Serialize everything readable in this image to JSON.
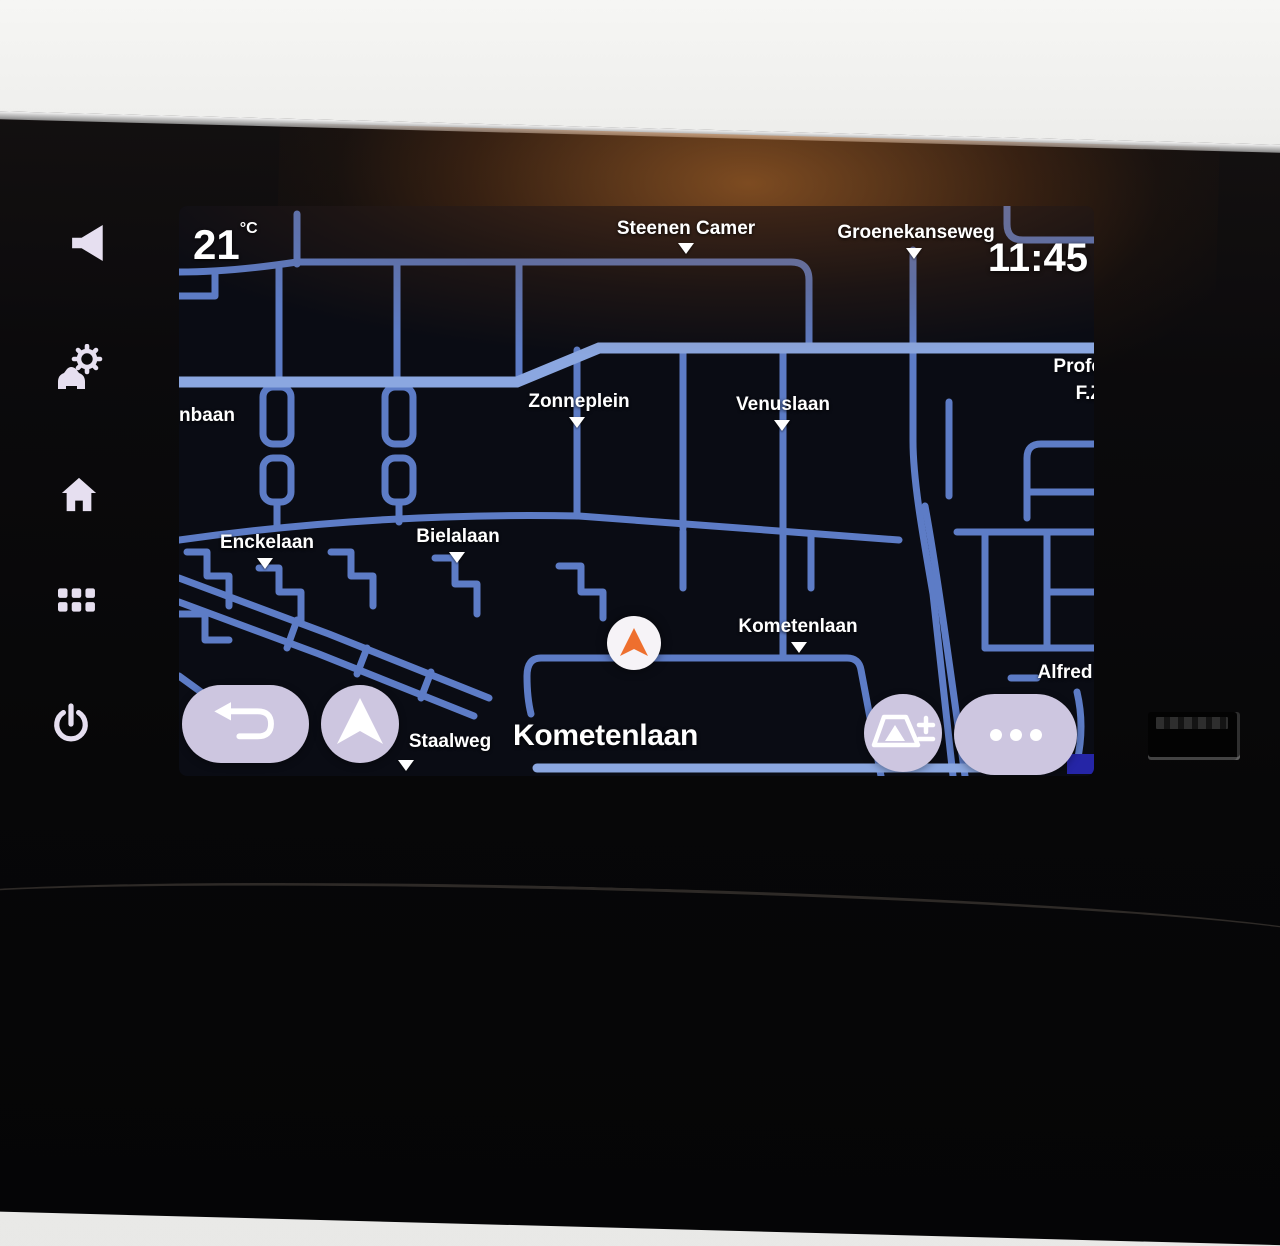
{
  "status_bar": {
    "temperature_value": "21",
    "temperature_unit": "°C",
    "clock": "11:45"
  },
  "map": {
    "current_street": "Kometenlaan",
    "labels": {
      "steenen_camer": "Steenen Camer",
      "groenekanseweg": "Groenekanseweg",
      "zonneplein": "Zonneplein",
      "venuslaan": "Venuslaan",
      "nbaan": "nbaan",
      "professor_line1": "Profe",
      "professor_line2": "F.Z",
      "enckelaan": "Enckelaan",
      "bielalaan": "Bielalaan",
      "kometenlaan": "Kometenlaan",
      "staalweg": "Staalweg",
      "alfred": "Alfred"
    },
    "colors": {
      "map_background": "#0a0c14",
      "road": "#5d7cc6",
      "road_major": "#8ba7e0",
      "label_text": "#ffffff",
      "position_arrow": "#ee6f2e",
      "highlight_rect": "#2525a6",
      "button_background": "#cdc6e0"
    }
  },
  "controls": {
    "back_button_icon": "return-arrow",
    "navigation_button_icon": "navigation-arrow",
    "map_zoom_button_icon": "map-perspective-plus-minus",
    "more_button_icon": "ellipsis"
  },
  "bezel_buttons": [
    {
      "icon": "volume-speaker"
    },
    {
      "icon": "vehicle-settings-gear"
    },
    {
      "icon": "home"
    },
    {
      "icon": "app-grid"
    },
    {
      "icon": "power"
    }
  ]
}
